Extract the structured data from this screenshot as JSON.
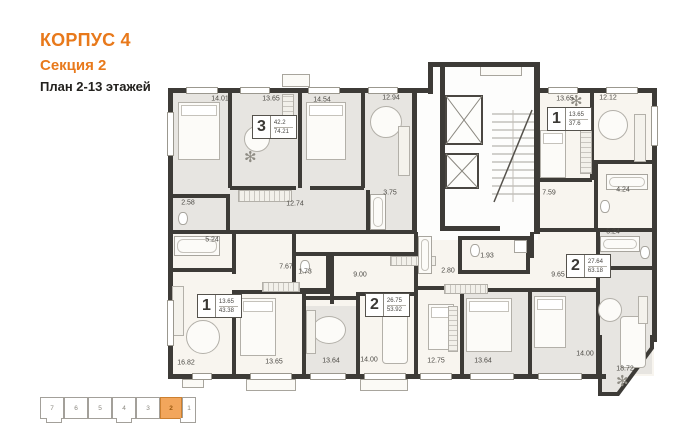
{
  "header": {
    "building": "КОРПУС 4",
    "section": "Секция 2",
    "floors": "План 2-13 этажей"
  },
  "colors": {
    "accent": "#E8791B",
    "wall": "#3D3B37",
    "room_light": "#F8F5EF",
    "room_gray": "#E7E5E1",
    "mini_active": "#F2A65C"
  },
  "plan": {
    "badges": [
      {
        "rooms": "3",
        "living": "42.2",
        "total": "74.21",
        "x": 252,
        "y": 115
      },
      {
        "rooms": "1",
        "living": "13.65",
        "total": "37.6",
        "x": 547,
        "y": 107
      },
      {
        "rooms": "1",
        "living": "13.65",
        "total": "43.38",
        "x": 197,
        "y": 294
      },
      {
        "rooms": "2",
        "living": "26.75",
        "total": "53.92",
        "x": 365,
        "y": 293
      },
      {
        "rooms": "2",
        "living": "27.64",
        "total": "63.18",
        "x": 566,
        "y": 254
      }
    ],
    "area_labels": [
      {
        "t": "14.01",
        "x": 220,
        "y": 99
      },
      {
        "t": "13.65",
        "x": 271,
        "y": 99
      },
      {
        "t": "14.54",
        "x": 322,
        "y": 100
      },
      {
        "t": "12.94",
        "x": 391,
        "y": 98
      },
      {
        "t": "13.65",
        "x": 565,
        "y": 99
      },
      {
        "t": "12.12",
        "x": 608,
        "y": 98
      },
      {
        "t": "2.58",
        "x": 188,
        "y": 203
      },
      {
        "t": "12.74",
        "x": 295,
        "y": 204
      },
      {
        "t": "3.75",
        "x": 390,
        "y": 193
      },
      {
        "t": "7.59",
        "x": 549,
        "y": 193
      },
      {
        "t": "4.24",
        "x": 623,
        "y": 190
      },
      {
        "t": "5.24",
        "x": 212,
        "y": 240
      },
      {
        "t": "5.24",
        "x": 613,
        "y": 232
      },
      {
        "t": "7.67",
        "x": 286,
        "y": 267
      },
      {
        "t": "1.73",
        "x": 305,
        "y": 272
      },
      {
        "t": "9.00",
        "x": 360,
        "y": 275
      },
      {
        "t": "2.80",
        "x": 448,
        "y": 271
      },
      {
        "t": "1.93",
        "x": 487,
        "y": 256
      },
      {
        "t": "9.65",
        "x": 558,
        "y": 275
      },
      {
        "t": "16.82",
        "x": 186,
        "y": 363
      },
      {
        "t": "13.65",
        "x": 274,
        "y": 362
      },
      {
        "t": "13.64",
        "x": 331,
        "y": 361
      },
      {
        "t": "14.00",
        "x": 369,
        "y": 360
      },
      {
        "t": "12.75",
        "x": 436,
        "y": 361
      },
      {
        "t": "13.64",
        "x": 483,
        "y": 361
      },
      {
        "t": "14.00",
        "x": 585,
        "y": 354
      },
      {
        "t": "18.72",
        "x": 625,
        "y": 369
      }
    ],
    "furniture": [
      {
        "k": "bed",
        "x": 178,
        "y": 102,
        "w": 42,
        "h": 58
      },
      {
        "k": "bed",
        "x": 306,
        "y": 102,
        "w": 40,
        "h": 58
      },
      {
        "k": "bed",
        "x": 540,
        "y": 130,
        "w": 26,
        "h": 48
      },
      {
        "k": "bed",
        "x": 240,
        "y": 298,
        "w": 36,
        "h": 58
      },
      {
        "k": "bed",
        "x": 466,
        "y": 298,
        "w": 46,
        "h": 54
      },
      {
        "k": "bed",
        "x": 534,
        "y": 296,
        "w": 32,
        "h": 52
      },
      {
        "k": "bed",
        "x": 428,
        "y": 304,
        "w": 26,
        "h": 46
      },
      {
        "k": "sofa",
        "x": 382,
        "y": 308,
        "w": 26,
        "h": 56
      },
      {
        "k": "sofa",
        "x": 620,
        "y": 316,
        "w": 26,
        "h": 52
      },
      {
        "k": "table",
        "x": 370,
        "y": 106,
        "w": 32,
        "h": 32
      },
      {
        "k": "table",
        "x": 598,
        "y": 110,
        "w": 30,
        "h": 30
      },
      {
        "k": "table",
        "x": 186,
        "y": 320,
        "w": 34,
        "h": 34
      },
      {
        "k": "table",
        "x": 312,
        "y": 316,
        "w": 34,
        "h": 28
      },
      {
        "k": "table",
        "x": 244,
        "y": 126,
        "w": 26,
        "h": 26
      },
      {
        "k": "table",
        "x": 598,
        "y": 298,
        "w": 24,
        "h": 24
      },
      {
        "k": "wardrobe",
        "x": 238,
        "y": 190,
        "w": 54,
        "h": 12
      },
      {
        "k": "wardrobe",
        "x": 262,
        "y": 282,
        "w": 38,
        "h": 10
      },
      {
        "k": "wardrobe",
        "x": 390,
        "y": 256,
        "w": 46,
        "h": 10
      },
      {
        "k": "wardrobe",
        "x": 444,
        "y": 284,
        "w": 44,
        "h": 10
      },
      {
        "k": "wardrobe-v",
        "x": 580,
        "y": 112,
        "w": 12,
        "h": 62
      },
      {
        "k": "wardrobe-v",
        "x": 282,
        "y": 94,
        "w": 12,
        "h": 34
      },
      {
        "k": "wardrobe-v",
        "x": 448,
        "y": 306,
        "w": 10,
        "h": 46
      },
      {
        "k": "counter",
        "x": 398,
        "y": 126,
        "w": 12,
        "h": 50
      },
      {
        "k": "counter",
        "x": 634,
        "y": 114,
        "w": 12,
        "h": 48
      },
      {
        "k": "counter",
        "x": 172,
        "y": 286,
        "w": 12,
        "h": 50
      },
      {
        "k": "counter",
        "x": 306,
        "y": 310,
        "w": 10,
        "h": 44
      },
      {
        "k": "counter",
        "x": 638,
        "y": 296,
        "w": 10,
        "h": 28
      },
      {
        "k": "tub",
        "x": 174,
        "y": 236,
        "w": 46,
        "h": 20
      },
      {
        "k": "tub",
        "x": 370,
        "y": 194,
        "w": 16,
        "h": 36
      },
      {
        "k": "tub",
        "x": 606,
        "y": 174,
        "w": 42,
        "h": 16
      },
      {
        "k": "tub",
        "x": 600,
        "y": 236,
        "w": 40,
        "h": 16
      },
      {
        "k": "tub",
        "x": 418,
        "y": 236,
        "w": 14,
        "h": 38
      },
      {
        "k": "wc",
        "x": 178,
        "y": 212,
        "w": 10,
        "h": 13
      },
      {
        "k": "wc",
        "x": 300,
        "y": 260,
        "w": 10,
        "h": 13
      },
      {
        "k": "wc",
        "x": 470,
        "y": 244,
        "w": 10,
        "h": 13
      },
      {
        "k": "wc",
        "x": 640,
        "y": 246,
        "w": 10,
        "h": 13
      },
      {
        "k": "wc",
        "x": 600,
        "y": 200,
        "w": 10,
        "h": 13
      },
      {
        "k": "washer",
        "x": 514,
        "y": 240,
        "w": 13,
        "h": 13
      },
      {
        "k": "plant",
        "x": 570,
        "y": 94,
        "w": 18,
        "h": 18
      },
      {
        "k": "plant",
        "x": 616,
        "y": 374,
        "w": 20,
        "h": 20
      },
      {
        "k": "plant",
        "x": 244,
        "y": 150,
        "w": 14,
        "h": 14
      }
    ]
  },
  "section_nav": {
    "items": [
      {
        "label": "7"
      },
      {
        "label": "6"
      },
      {
        "label": "5"
      },
      {
        "label": "4"
      },
      {
        "label": "3"
      },
      {
        "label": "2",
        "active": true
      },
      {
        "label": "1"
      }
    ]
  }
}
